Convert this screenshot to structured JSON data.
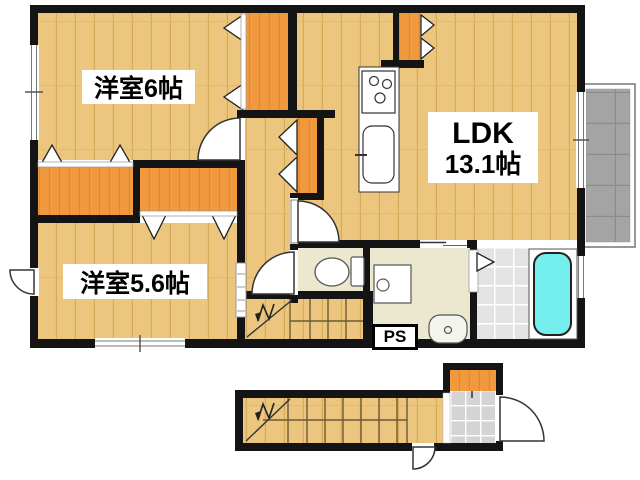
{
  "floor_plan": {
    "second_floor": {
      "rooms": [
        {
          "name": "western-room-6",
          "label": "洋室6帖"
        },
        {
          "name": "ldk",
          "label_line1": "LDK",
          "label_line2": "13.1帖"
        },
        {
          "name": "western-room-5-6",
          "label": "洋室5.6帖"
        },
        {
          "name": "pipe-space",
          "label": "PS"
        }
      ],
      "fixtures": [
        "kitchen-stove",
        "kitchen-sink",
        "toilet",
        "washing-machine",
        "wash-basin",
        "bathtub",
        "balcony",
        "upper-staircase",
        "closets"
      ]
    },
    "first_floor": {
      "fixtures": [
        "lower-staircase",
        "shoe-cabinet",
        "entrance-tile",
        "front-door"
      ]
    },
    "colors": {
      "wall": "#141414",
      "wood_floor": "#ecc57e",
      "closet_orange": "#f0993f",
      "sanitary_floor": "#ebe8cf",
      "bath_tile": "#e3e3e3",
      "bathtub": "#74efed",
      "balcony": "#a4a4a4",
      "entry_tile": "#d4d4d4"
    }
  }
}
